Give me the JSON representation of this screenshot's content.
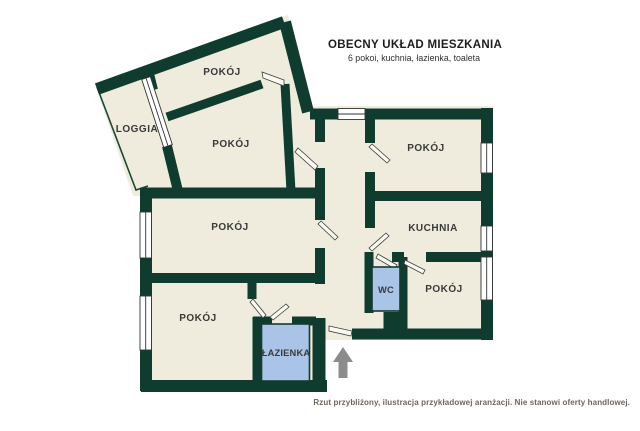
{
  "header": {
    "title": "OBECNY UKŁAD MIESZKANIA",
    "subtitle": "6 pokoi, kuchnia, łazienka, toaleta"
  },
  "footer": {
    "disclaimer": "Rzut przybliżony, ilustracja przykładowej aranżacji. Nie stanowi oferty handlowej."
  },
  "colors": {
    "wall": "#0f3c2e",
    "floor": "#efecdd",
    "highlight_room": "#a9c4e6",
    "window": "#ffffff",
    "arrow": "#8c8c8c",
    "label": "#3a3a3a",
    "background": "#ffffff"
  },
  "rooms": [
    {
      "id": "pokoj-top-rotated",
      "label": "POKÓJ",
      "highlighted": false
    },
    {
      "id": "loggia",
      "label": "LOGGIA",
      "highlighted": false
    },
    {
      "id": "pokoj-second-rotated",
      "label": "POKÓJ",
      "highlighted": false
    },
    {
      "id": "pokoj-top-right",
      "label": "POKÓJ",
      "highlighted": false
    },
    {
      "id": "pokoj-middle-left",
      "label": "POKÓJ",
      "highlighted": false
    },
    {
      "id": "kuchnia",
      "label": "KUCHNIA",
      "highlighted": false
    },
    {
      "id": "wc",
      "label": "WC",
      "highlighted": true
    },
    {
      "id": "pokoj-bottom-right",
      "label": "POKÓJ",
      "highlighted": false
    },
    {
      "id": "pokoj-bottom-left",
      "label": "POKÓJ",
      "highlighted": false
    },
    {
      "id": "lazienka",
      "label": "ŁAZIENKA",
      "highlighted": true
    }
  ],
  "entrance": {
    "symbol": "up-arrow"
  }
}
